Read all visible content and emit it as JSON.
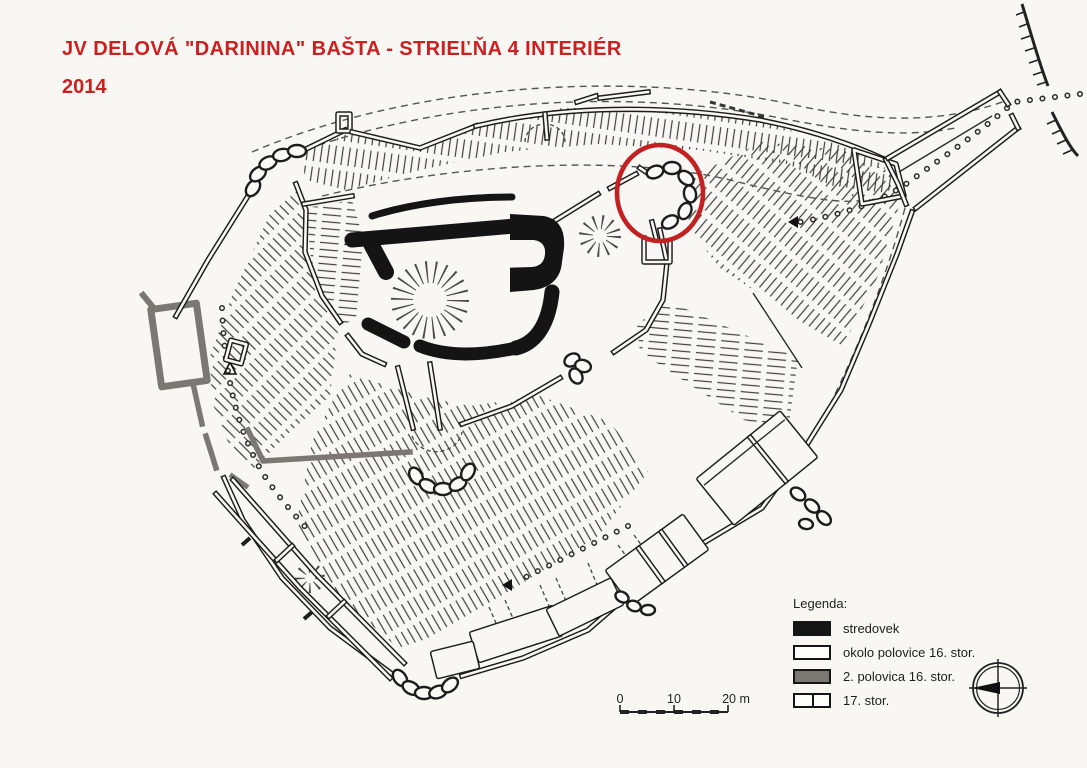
{
  "document": {
    "title_line1": "JV DELOVÁ \"DARININA\" BAŠTA - STRIEĽŇA 4 INTERIÉR",
    "title_line2": "2014"
  },
  "legend": {
    "title": "Legenda:",
    "items": [
      {
        "label": "stredovek",
        "swatch": "black",
        "color": "#151515"
      },
      {
        "label": "okolo polovice 16. stor.",
        "swatch": "white",
        "color": "#fdfdfb"
      },
      {
        "label": "2. polovica 16. stor.",
        "swatch": "gray",
        "color": "#7b7773"
      },
      {
        "label": "17. stor.",
        "swatch": "white-divided",
        "color": "#fdfdfb"
      }
    ]
  },
  "scale_bar": {
    "labels": [
      "0",
      "10",
      "20 m"
    ]
  },
  "compass": {
    "icon": "compass-rose",
    "needle_points": "west"
  },
  "highlight": {
    "shape": "ellipse",
    "color": "#c32121"
  },
  "colors": {
    "background": "#f8f7f4",
    "ink": "#1c1c1c",
    "title_red": "#cc2020",
    "highlight_red": "#c32121",
    "wall_gray": "#7b7773"
  }
}
